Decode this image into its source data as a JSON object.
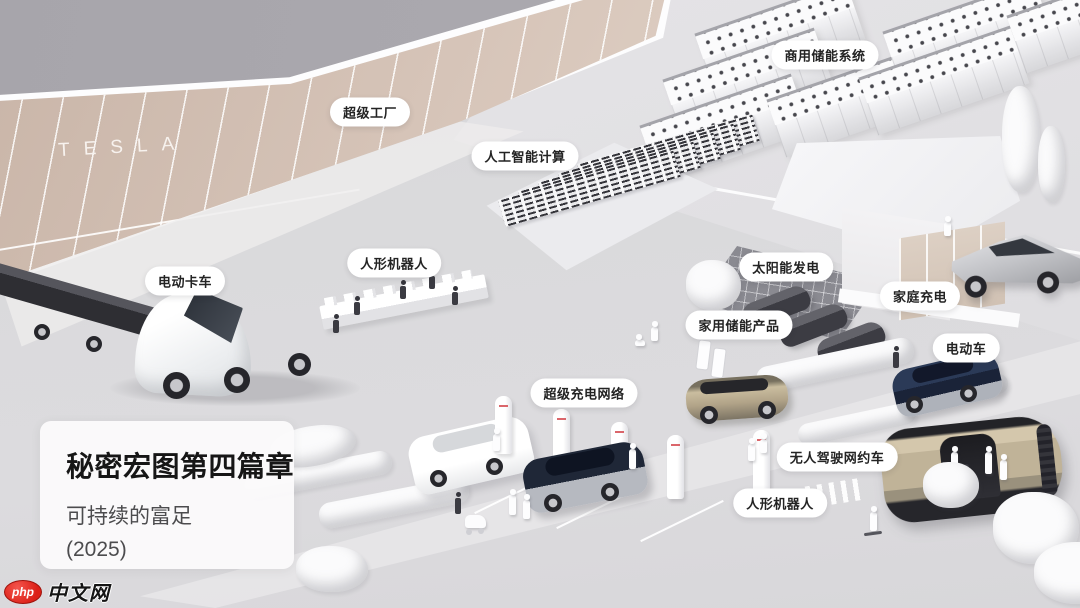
{
  "factory": {
    "sign": "TESLA"
  },
  "labels": [
    {
      "id": "commercial-energy-storage",
      "text": "商用储能系统",
      "x": 825,
      "y": 55
    },
    {
      "id": "gigafactory",
      "text": "超级工厂",
      "x": 370,
      "y": 112
    },
    {
      "id": "ai-computing",
      "text": "人工智能计算",
      "x": 525,
      "y": 156
    },
    {
      "id": "electric-truck",
      "text": "电动卡车",
      "x": 185,
      "y": 281
    },
    {
      "id": "humanoid-robot-factory",
      "text": "人形机器人",
      "x": 394,
      "y": 263
    },
    {
      "id": "solar-power",
      "text": "太阳能发电",
      "x": 786,
      "y": 267
    },
    {
      "id": "home-energy-storage",
      "text": "家用储能产品",
      "x": 739,
      "y": 325
    },
    {
      "id": "home-charging",
      "text": "家庭充电",
      "x": 920,
      "y": 296
    },
    {
      "id": "electric-car",
      "text": "电动车",
      "x": 966,
      "y": 348
    },
    {
      "id": "supercharger-network",
      "text": "超级充电网络",
      "x": 584,
      "y": 393
    },
    {
      "id": "robotaxi",
      "text": "无人驾驶网约车",
      "x": 837,
      "y": 457
    },
    {
      "id": "humanoid-robot-street",
      "text": "人形机器人",
      "x": 780,
      "y": 503
    }
  ],
  "title_card": {
    "title": "秘密宏图第四篇章",
    "subtitle": "可持续的富足",
    "year": "(2025)"
  },
  "watermark": {
    "logo": "php",
    "site": "中文网"
  },
  "colors": {
    "sky": "#a9a7ae",
    "factory_wall": "#d8c6ba",
    "ground": "#d9d8db",
    "accent_red": "#dc1f16",
    "gold": "#bfb298",
    "dark": "#2c2c31"
  }
}
